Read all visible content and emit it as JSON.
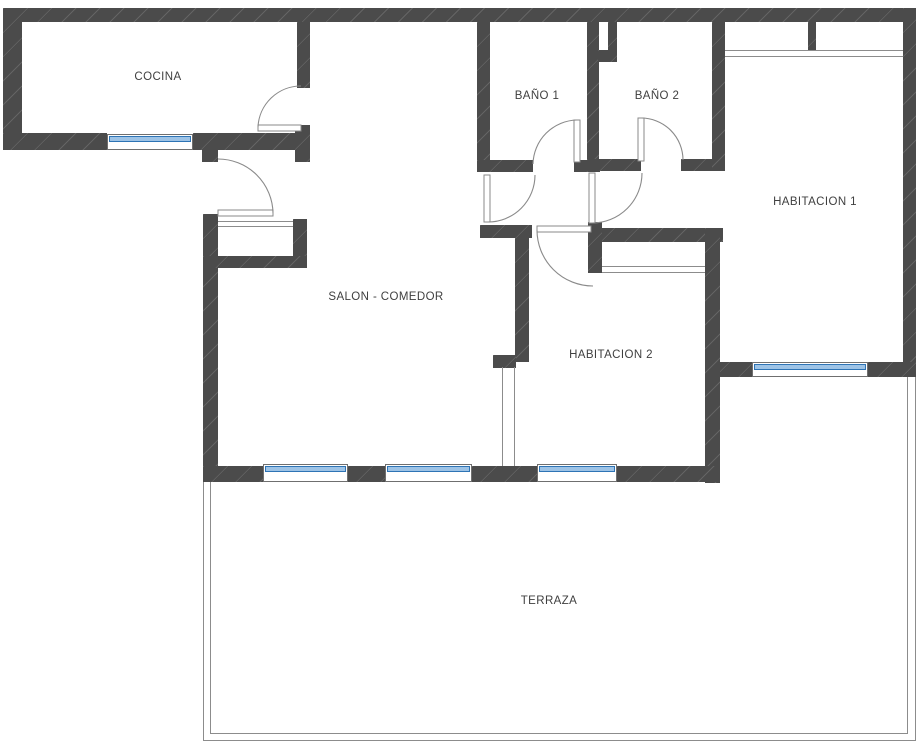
{
  "title": "Plano de vivienda",
  "rooms": {
    "cocina": {
      "label": "COCINA"
    },
    "bano1": {
      "label": "BAÑO 1"
    },
    "bano2": {
      "label": "BAÑO 2"
    },
    "habitacion1": {
      "label": "HABITACION 1"
    },
    "salon": {
      "label": "SALON - COMEDOR"
    },
    "habitacion2": {
      "label": "HABITACION 2"
    },
    "terraza": {
      "label": "TERRAZA"
    }
  },
  "palette": {
    "background": "#ffffff",
    "wall": "#4b4b4b",
    "line": "#8c8c8c",
    "arc": "#8a8a8a",
    "text": "#3f3f3f",
    "window_blue": "#9dc3e6",
    "window_blue_edge": "#2e74b5"
  }
}
